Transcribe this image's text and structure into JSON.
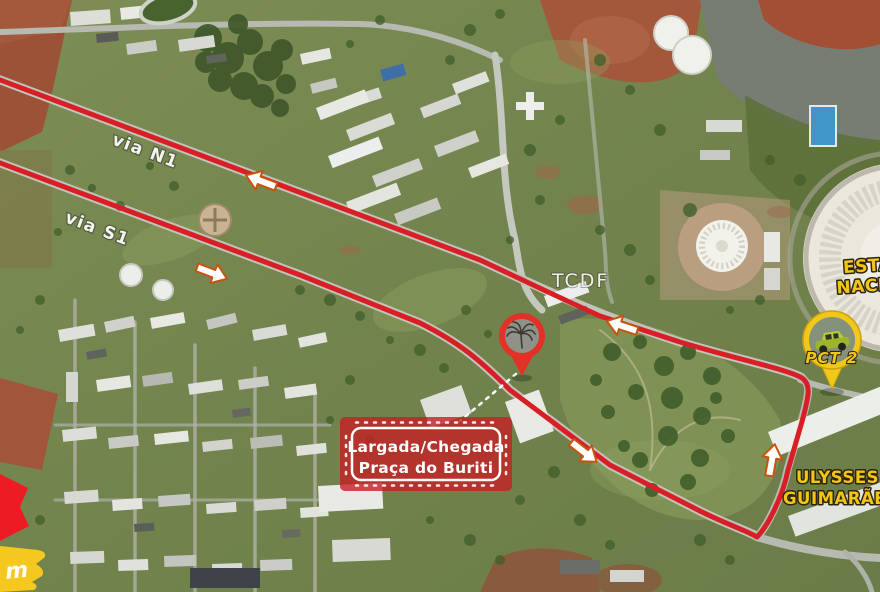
{
  "map": {
    "type": "satellite-race-route-map",
    "road_labels": {
      "via_n1": "via N1",
      "via_s1": "via S1"
    },
    "poi": {
      "tcdf": "TCDF"
    },
    "start_finish": {
      "line1": "Largada/Chegada",
      "line2": "Praça do Buriti"
    },
    "stadium": {
      "line1": "ESTÁDIO",
      "line2": "NACIONAL"
    },
    "convention_center": {
      "line1": "ULYSSES",
      "line2": "GUIMARÃES"
    },
    "checkpoint": {
      "label": "PCT 2"
    },
    "distance_fragment": "m",
    "colors": {
      "route": "#d91f26",
      "arrow_fill": "#ffffff",
      "arrow_outline": "#c75310",
      "start_finish_box": "#c32026",
      "yellow_label": "#f5c516",
      "pin_red": "#e23127",
      "pin_yellow": "#f2c71c"
    }
  }
}
